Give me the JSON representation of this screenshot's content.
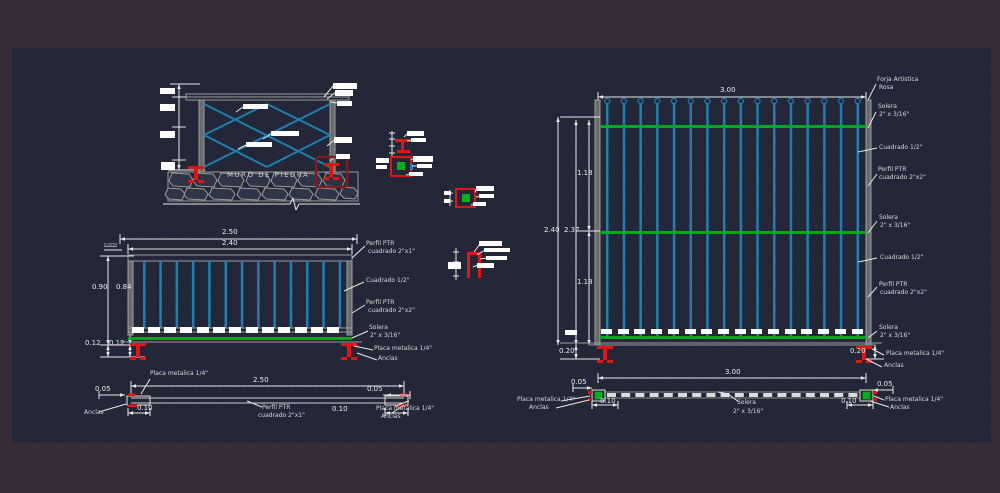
{
  "drawing": {
    "type_note": "CAD detail sheet - metal fence / herreria"
  },
  "colors": {
    "border": "#382c38",
    "canvas": "#1b1e2d",
    "bar_blue": "#1e7fb2",
    "solera_green": "#00a81e",
    "anchor_red": "#e81212",
    "dark_red": "#7d1d1d",
    "line_gray": "#9c9c9c",
    "text": "#d9d9d9"
  },
  "section": {
    "title": "MURO DE PIEDRA"
  },
  "left_elev": {
    "dim_top_outer": "2.50",
    "dim_top_inner": "2.40",
    "dim_rail": "0.0254",
    "dim_height_outer": "0.90",
    "dim_height_inner": "0.84",
    "dim_base_a": "0.12",
    "dim_base_b": "0.12",
    "callouts": [
      {
        "l1": "Perfil PTR",
        "l2": "cuadrado 2\"x1\""
      },
      {
        "l1": "Cuadrado 1/2\"",
        "l2": ""
      },
      {
        "l1": "Perfil PTR",
        "l2": "cuadrado 2\"x2\""
      },
      {
        "l1": "Solera",
        "l2": "2\" x 3/16\""
      },
      {
        "l1": "Placa metalica 1/4\"",
        "l2": ""
      },
      {
        "l1": "Anclas",
        "l2": ""
      }
    ]
  },
  "right_elev": {
    "dim_width": "3.00",
    "dim_height_outer": "2.40",
    "dim_height_inner": "2.37",
    "dim_seg_top": "1.18",
    "dim_seg_bottom": "1.18",
    "dim_base_left": "0.20",
    "dim_base_right": "0.20",
    "callouts": [
      {
        "l1": "Forja Artistica",
        "l2": "Rosa"
      },
      {
        "l1": "Solera",
        "l2": "2\" x 3/16\""
      },
      {
        "l1": "Cuadrado 1/2\"",
        "l2": ""
      },
      {
        "l1": "Perfil PTR",
        "l2": "cuadrado 2\"x2\""
      },
      {
        "l1": "Solera",
        "l2": "2\" x 3/16\""
      },
      {
        "l1": "Cuadrado 1/2\"",
        "l2": ""
      },
      {
        "l1": "Perfil PTR",
        "l2": "cuadrado 2\"x2\""
      },
      {
        "l1": "Solera",
        "l2": "2\" x 3/16\""
      },
      {
        "l1": "Placa metalica 1/4\"",
        "l2": ""
      },
      {
        "l1": "Anclas",
        "l2": ""
      }
    ]
  },
  "left_plan": {
    "dim_width": "2.50",
    "dim_end_left": "0.05",
    "dim_end_right": "0.05",
    "dim_plate_left": "0.10",
    "dim_plate_right": "0.10",
    "label_placa_top": "Placa metalica 1/4\"",
    "label_anclas_left": "Anclas",
    "label_perfil_l1": "Perfil PTR",
    "label_perfil_l2": "cuadrado 2\"x1\"",
    "label_placa_right": "Placa metalica 1/4\"",
    "label_anclas_right": "Anclas"
  },
  "right_plan": {
    "dim_width": "3.00",
    "dim_end_left": "0.05",
    "dim_end_right": "0.05",
    "dim_plate_left": "0.10",
    "dim_plate_right": "0.10",
    "label_placa_left": "Placa metalica 1/4\"",
    "label_anclas_left": "Anclas",
    "label_solera_l1": "Solera",
    "label_solera_l2": "2\" x 3/16\"",
    "label_placa_right": "Placa metalica 1/4\"",
    "label_anclas_right": "Anclas"
  }
}
